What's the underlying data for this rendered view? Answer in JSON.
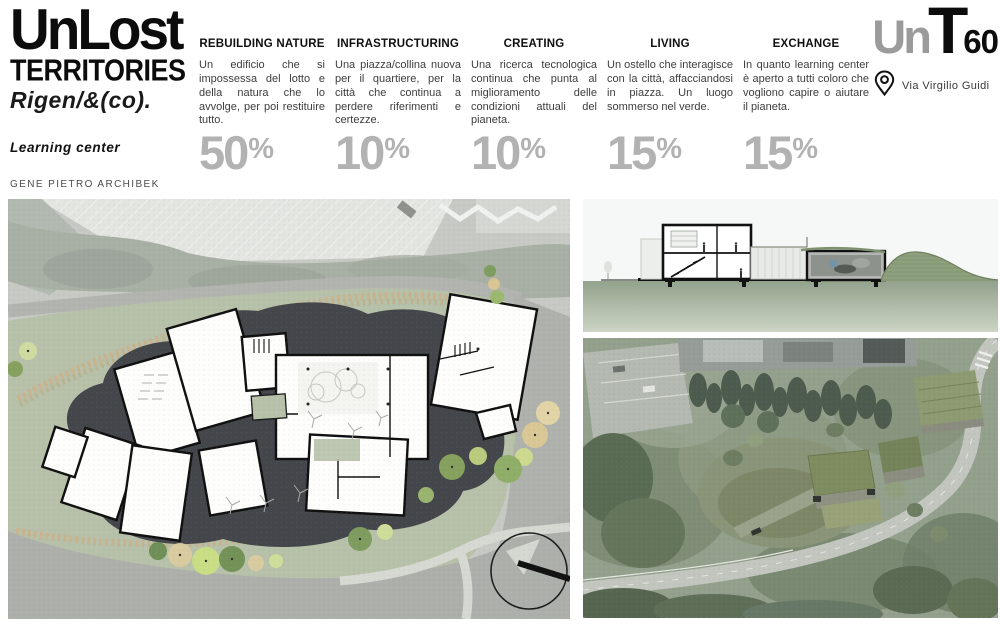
{
  "header": {
    "title": "UnLost",
    "title2": "TERRITORIES",
    "title3": "Rigen/&(co).",
    "subtitle": "Learning center",
    "author": "GENE PIETRO ARCHIBEK"
  },
  "logo": {
    "un": "Un",
    "t": "T",
    "sixty": "60",
    "address": "Via Virgilio Guidi"
  },
  "columns": [
    {
      "heading": "REBUILDING NATURE",
      "body": "Un edificio che si impossessa del lotto e della natura che lo avvolge, per poi restituire tutto.",
      "percent_value": "50",
      "percent_sign": "%"
    },
    {
      "heading": "INFRASTRUCTURING",
      "body": "Una piazza/collina nuova per il quartiere, per la città che continua a perdere riferimenti e certezze.",
      "percent_value": "10",
      "percent_sign": "%"
    },
    {
      "heading": "CREATING",
      "body": "Una ricerca tecnologica continua che punta al miglioramento delle condizioni attuali del pianeta.",
      "percent_value": "10",
      "percent_sign": "%"
    },
    {
      "heading": "LIVING",
      "body": "Un ostello che interagisce con la città, affacciandosi in piazza. Un luogo sommerso nel verde.",
      "percent_value": "15",
      "percent_sign": "%"
    },
    {
      "heading": "EXCHANGE",
      "body": "In quanto learning center è aperto a tutti coloro che vogliono capire o aiutare il pianeta.",
      "percent_value": "15",
      "percent_sign": "%"
    }
  ],
  "colors": {
    "percent_gray": "#b2b2b2",
    "logo_gray": "#9b9b9b",
    "ink": "#0c0c0c",
    "site_green": "#b7c1a9",
    "site_dark_blob": "#43464a",
    "road_gray": "#acafaa"
  }
}
